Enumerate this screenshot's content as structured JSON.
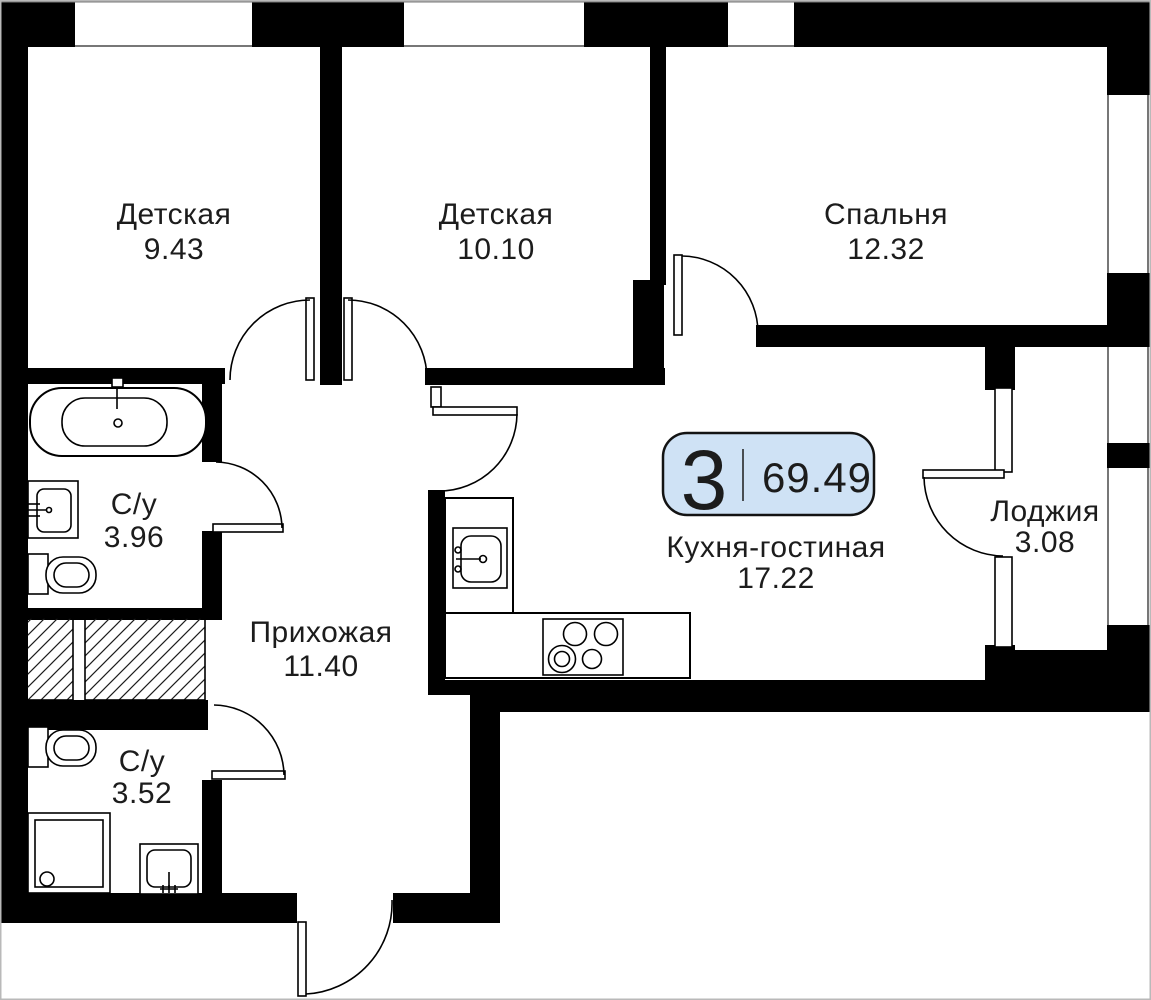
{
  "plan": {
    "badge": {
      "rooms_count": "3",
      "total_area": "69.49"
    },
    "rooms": [
      {
        "name": "Детская",
        "area": "9.43"
      },
      {
        "name": "Детская",
        "area": "10.10"
      },
      {
        "name": "Спальня",
        "area": "12.32"
      },
      {
        "name": "С/у",
        "area": "3.96"
      },
      {
        "name": "Прихожая",
        "area": "11.40"
      },
      {
        "name": "Кухня-гостиная",
        "area": "17.22"
      },
      {
        "name": "Лоджия",
        "area": "3.08"
      },
      {
        "name": "С/у",
        "area": "3.52"
      }
    ],
    "colors": {
      "wall": "#000000",
      "text": "#1c1c1c",
      "badge_bg": "#cfe2f5",
      "badge_border": "#131313",
      "window_line": "#777777"
    }
  }
}
